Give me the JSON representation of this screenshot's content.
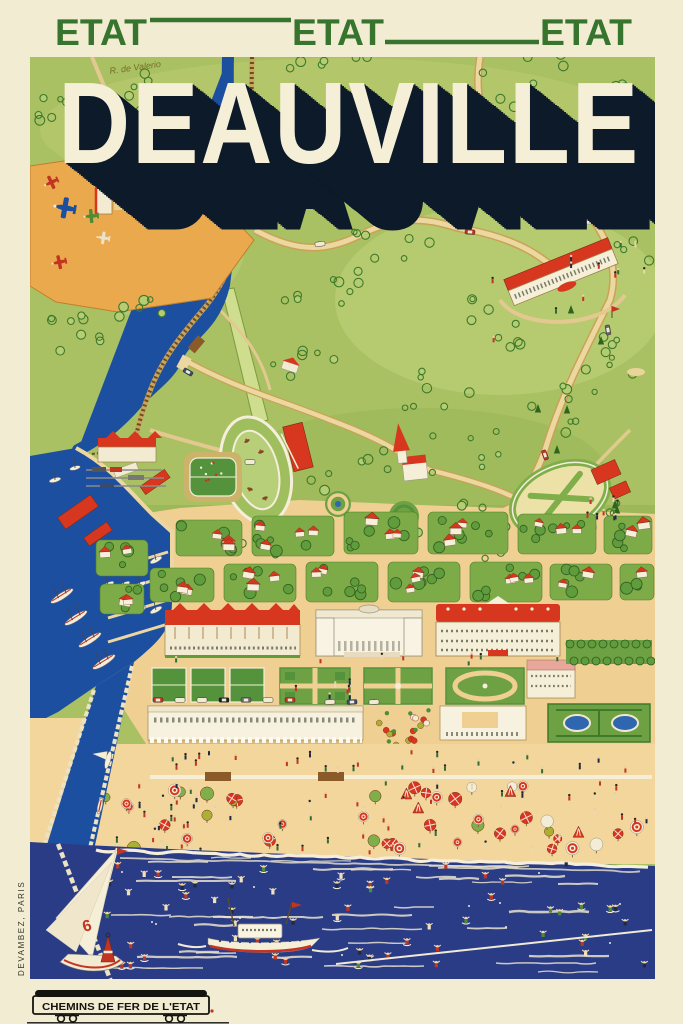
{
  "poster": {
    "header": {
      "labels": [
        "ETAT",
        "ETAT",
        "ETAT"
      ]
    },
    "title": {
      "text": "DEAUVILLE",
      "signature": "R. de Valerio"
    },
    "sea": {
      "sail_number": "6"
    },
    "footer": {
      "railway_logo": "CHEMINS DE FER DE L'ETAT",
      "printer": "DEVAMBEZ, PARIS"
    },
    "palette": {
      "cream": "#f2ecd2",
      "header_green": "#37752f",
      "title_cream": "#f6efd8",
      "title_shadow": "#0c1a2a",
      "map_green": "#a9c162",
      "map_green_light": "#b9cd74",
      "sea_navy": "#2b3c86",
      "water_blue": "#1d4fa0",
      "sand": "#f2d69c",
      "town_tan": "#f0cf92",
      "road_tan": "#ecd7a0",
      "roof_red": "#d8371f",
      "accent_red": "#c23522",
      "tree_green": "#5f9c3b",
      "tree_dark": "#335c22",
      "apron_orange": "#eba94e",
      "ink": "#15150f"
    }
  }
}
